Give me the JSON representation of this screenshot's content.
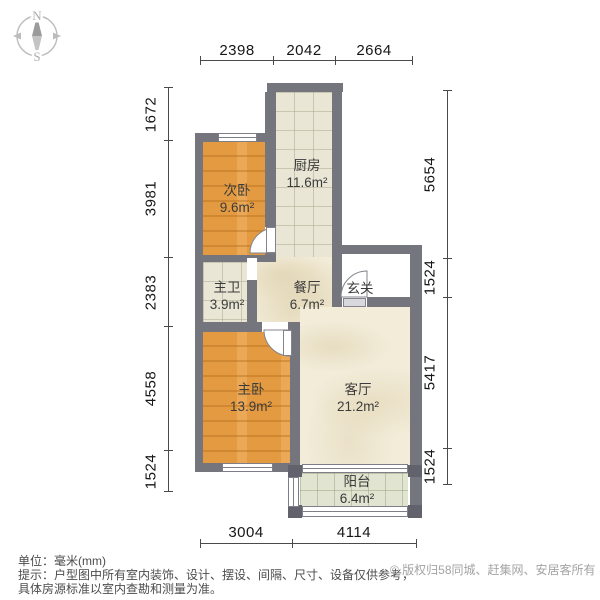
{
  "compass": {
    "north_label": "N",
    "south_label": "S"
  },
  "dimensions": {
    "top": [
      "2398",
      "2042",
      "2664"
    ],
    "bottom": [
      "3004",
      "4114"
    ],
    "left": [
      "1672",
      "3981",
      "2383",
      "4558",
      "1524"
    ],
    "right": [
      "5654",
      "1524",
      "5417",
      "1524"
    ]
  },
  "rooms": [
    {
      "name": "厨房",
      "area": "11.6m²"
    },
    {
      "name": "次卧",
      "area": "9.6m²"
    },
    {
      "name": "主卫",
      "area": "3.9m²"
    },
    {
      "name": "餐厅",
      "area": "6.7m²"
    },
    {
      "name": "玄关",
      "area": ""
    },
    {
      "name": "主卧",
      "area": "13.9m²"
    },
    {
      "name": "客厅",
      "area": "21.2m²"
    },
    {
      "name": "阳台",
      "area": "6.4m²"
    }
  ],
  "footer": {
    "unit_line": "单位：毫米(mm)",
    "tip_line1": "提示：户型图中所有室内装饰、设计、摆设、间隔、尺寸、设备仅供参考，",
    "tip_line2": "具体房源标准以室内查勘和测量为准。",
    "copyright": "© 版权归58同城、赶集网、安居客所有"
  },
  "colors": {
    "wall": "#75757e",
    "wood_floor": "#e49a40",
    "tile_floor": "#e9e6d5",
    "marble_floor": "#f2ecd9",
    "balcony_floor": "#e0e4d0"
  }
}
